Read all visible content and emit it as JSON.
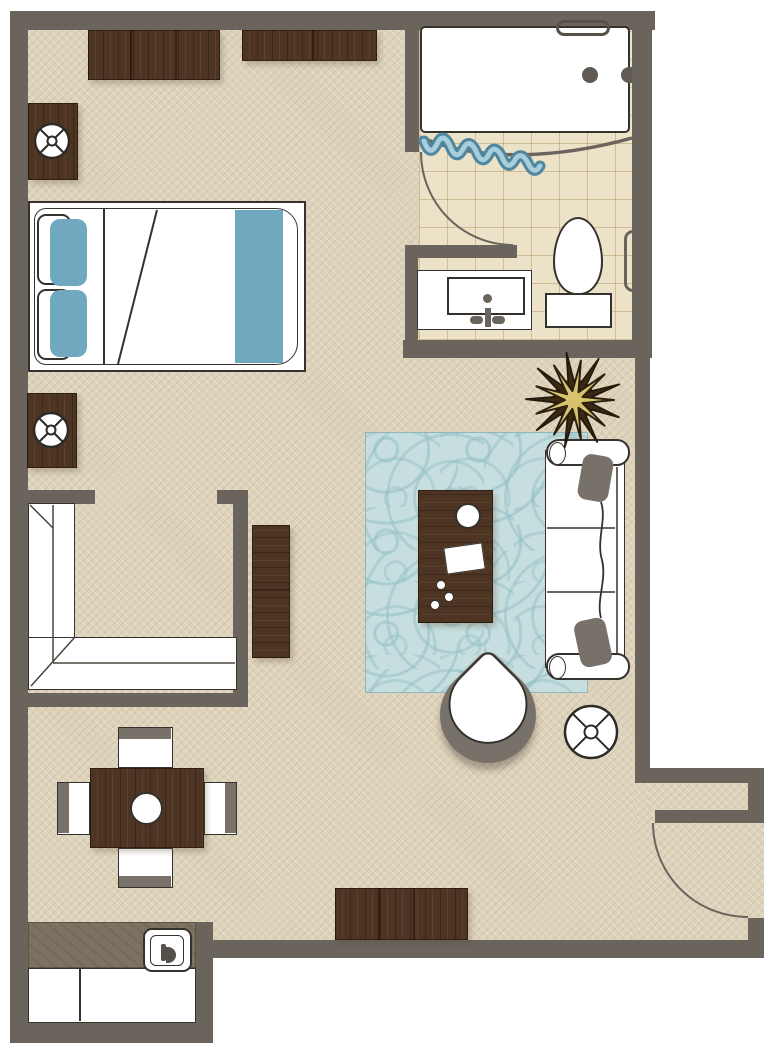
{
  "plan": {
    "type": "floor-plan",
    "unit": "studio-suite",
    "rooms": [
      {
        "name": "bedroom",
        "items": [
          "double-bed",
          "blue-pillows",
          "blue-bed-runner",
          "nightstand-upper",
          "nightstand-lower",
          "table-lamp-upper",
          "table-lamp-lower",
          "dresser-top-left",
          "dresser-top-right",
          "tv-console"
        ]
      },
      {
        "name": "bathroom",
        "items": [
          "bathtub",
          "tub-grab-handle",
          "tub-drain",
          "tub-faucet",
          "shower-curtain",
          "shower-rod",
          "bathroom-door",
          "toilet",
          "vanity-sink",
          "towel-bar",
          "tile-floor"
        ]
      },
      {
        "name": "closet",
        "items": [
          "l-shaped-wardrobe"
        ]
      },
      {
        "name": "living-area",
        "items": [
          "sofa",
          "throw-pillow-top",
          "throw-pillow-bottom",
          "coffee-table",
          "round-tray",
          "magazine",
          "decor-dots",
          "area-rug",
          "armchair",
          "round-side-table",
          "potted-plant"
        ]
      },
      {
        "name": "dining-area",
        "items": [
          "dining-table",
          "centerpiece",
          "dining-chair-top",
          "dining-chair-bottom",
          "dining-chair-left",
          "dining-chair-right"
        ]
      },
      {
        "name": "kitchenette",
        "items": [
          "countertop",
          "kitchen-sink",
          "base-cabinets"
        ]
      },
      {
        "name": "entry",
        "items": [
          "entry-door",
          "entry-niche",
          "console-bench"
        ]
      }
    ],
    "colors": {
      "wall": "#6b645d",
      "floor": "#ddd2ba",
      "tile": "#ece2c8",
      "wood": "#4e3422",
      "accent_blue": "#6fa8bf",
      "rug_blue": "#c6dedf",
      "gray_accent": "#77716a",
      "outline": "#35322d",
      "plant_leaf": "#d7c26e",
      "plant_pot": "#46301b",
      "white": "#ffffff"
    }
  }
}
